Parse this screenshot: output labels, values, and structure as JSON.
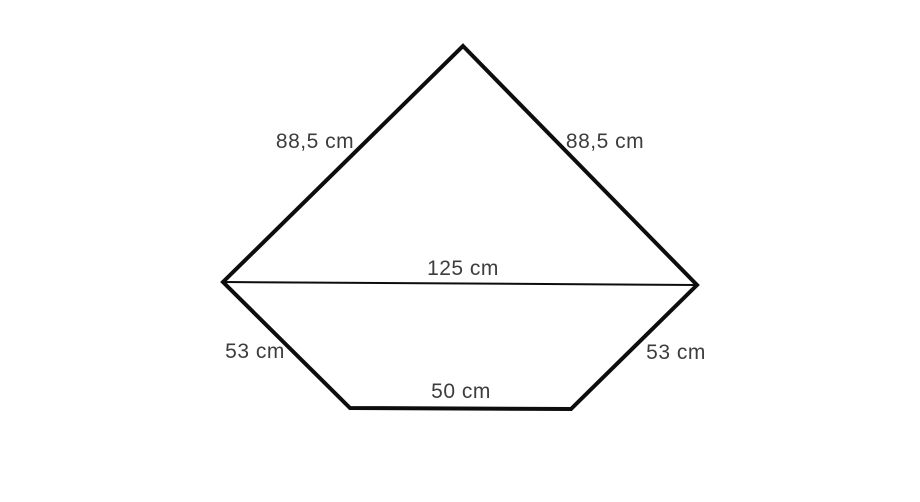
{
  "diagram": {
    "shape": "pentagon",
    "background_color": "#ffffff",
    "stroke_color": "#0d0d0d",
    "label_color": "#3d3d3d",
    "outline_stroke_width": 4,
    "diagonal_stroke_width": 2,
    "vertices": {
      "apex": [
        463,
        46
      ],
      "right": [
        697,
        285
      ],
      "bottom_right": [
        571,
        409
      ],
      "bottom_left": [
        350,
        408
      ],
      "left": [
        223,
        282
      ]
    },
    "outline_order": [
      "apex",
      "right",
      "bottom_right",
      "bottom_left",
      "left"
    ],
    "diagonal": {
      "from": "left",
      "to": "right"
    },
    "labels": [
      {
        "id": "upper-left-side",
        "text": "88,5 cm"
      },
      {
        "id": "upper-right-side",
        "text": "88,5 cm"
      },
      {
        "id": "diagonal",
        "text": "125 cm"
      },
      {
        "id": "lower-left-side",
        "text": "53 cm"
      },
      {
        "id": "lower-right-side",
        "text": "53 cm"
      },
      {
        "id": "bottom-side",
        "text": "50 cm"
      }
    ]
  }
}
